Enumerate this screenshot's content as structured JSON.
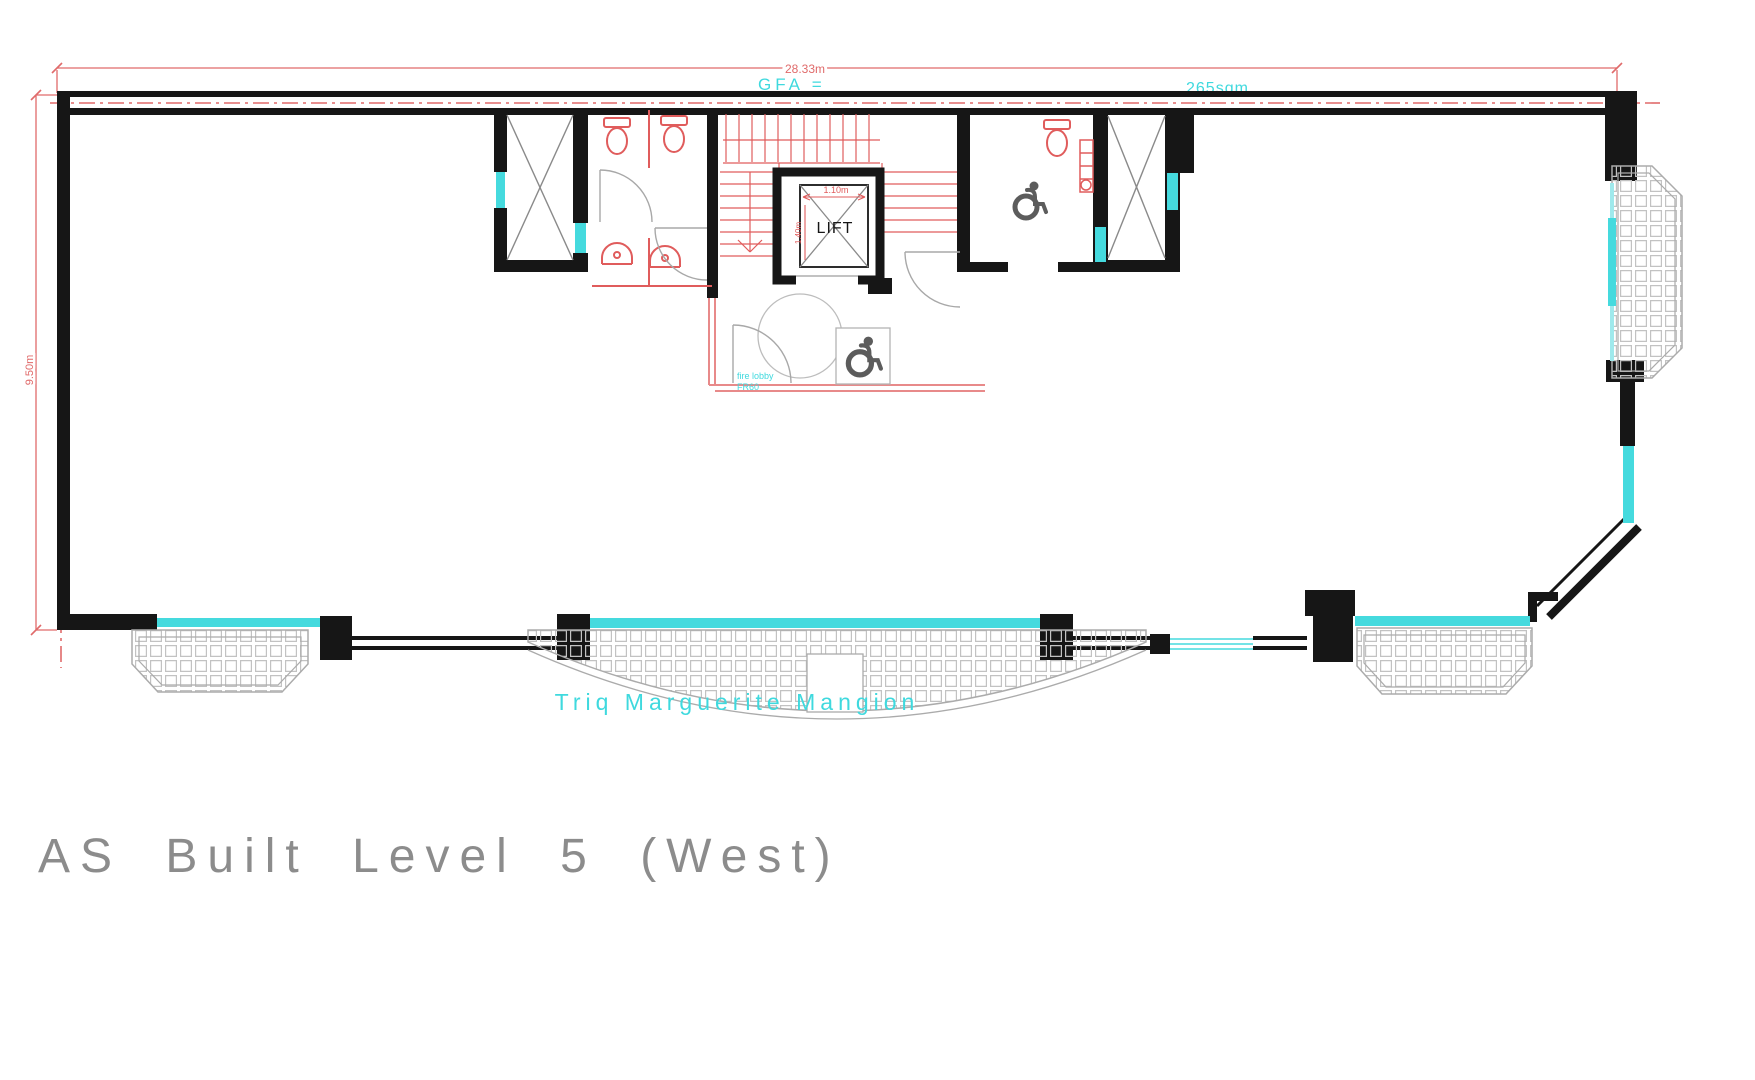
{
  "drawing": {
    "title": "AS Built Level 5 (West)",
    "street_label": "Triq Marguerite Mangion",
    "annotations": {
      "gfa_label": "GFA =",
      "gfa_value": "265sqm",
      "lift_label": "LIFT",
      "fire_lobby_line1": "fire lobby",
      "fire_lobby_line2": "FR60"
    },
    "dimensions": {
      "overall_width": "28.33m",
      "overall_depth": "9.50m",
      "lift_width": "1.10m",
      "lift_depth": "1.40m"
    },
    "colors": {
      "wall": "#161616",
      "dimension_red": "#e05c5c",
      "window_cyan": "#45dade",
      "label_cyan": "#3fd9de",
      "grid_gray": "#c2c2c2",
      "symbol_gray": "#5c5c5c",
      "title_gray": "#8c8c8c"
    }
  }
}
